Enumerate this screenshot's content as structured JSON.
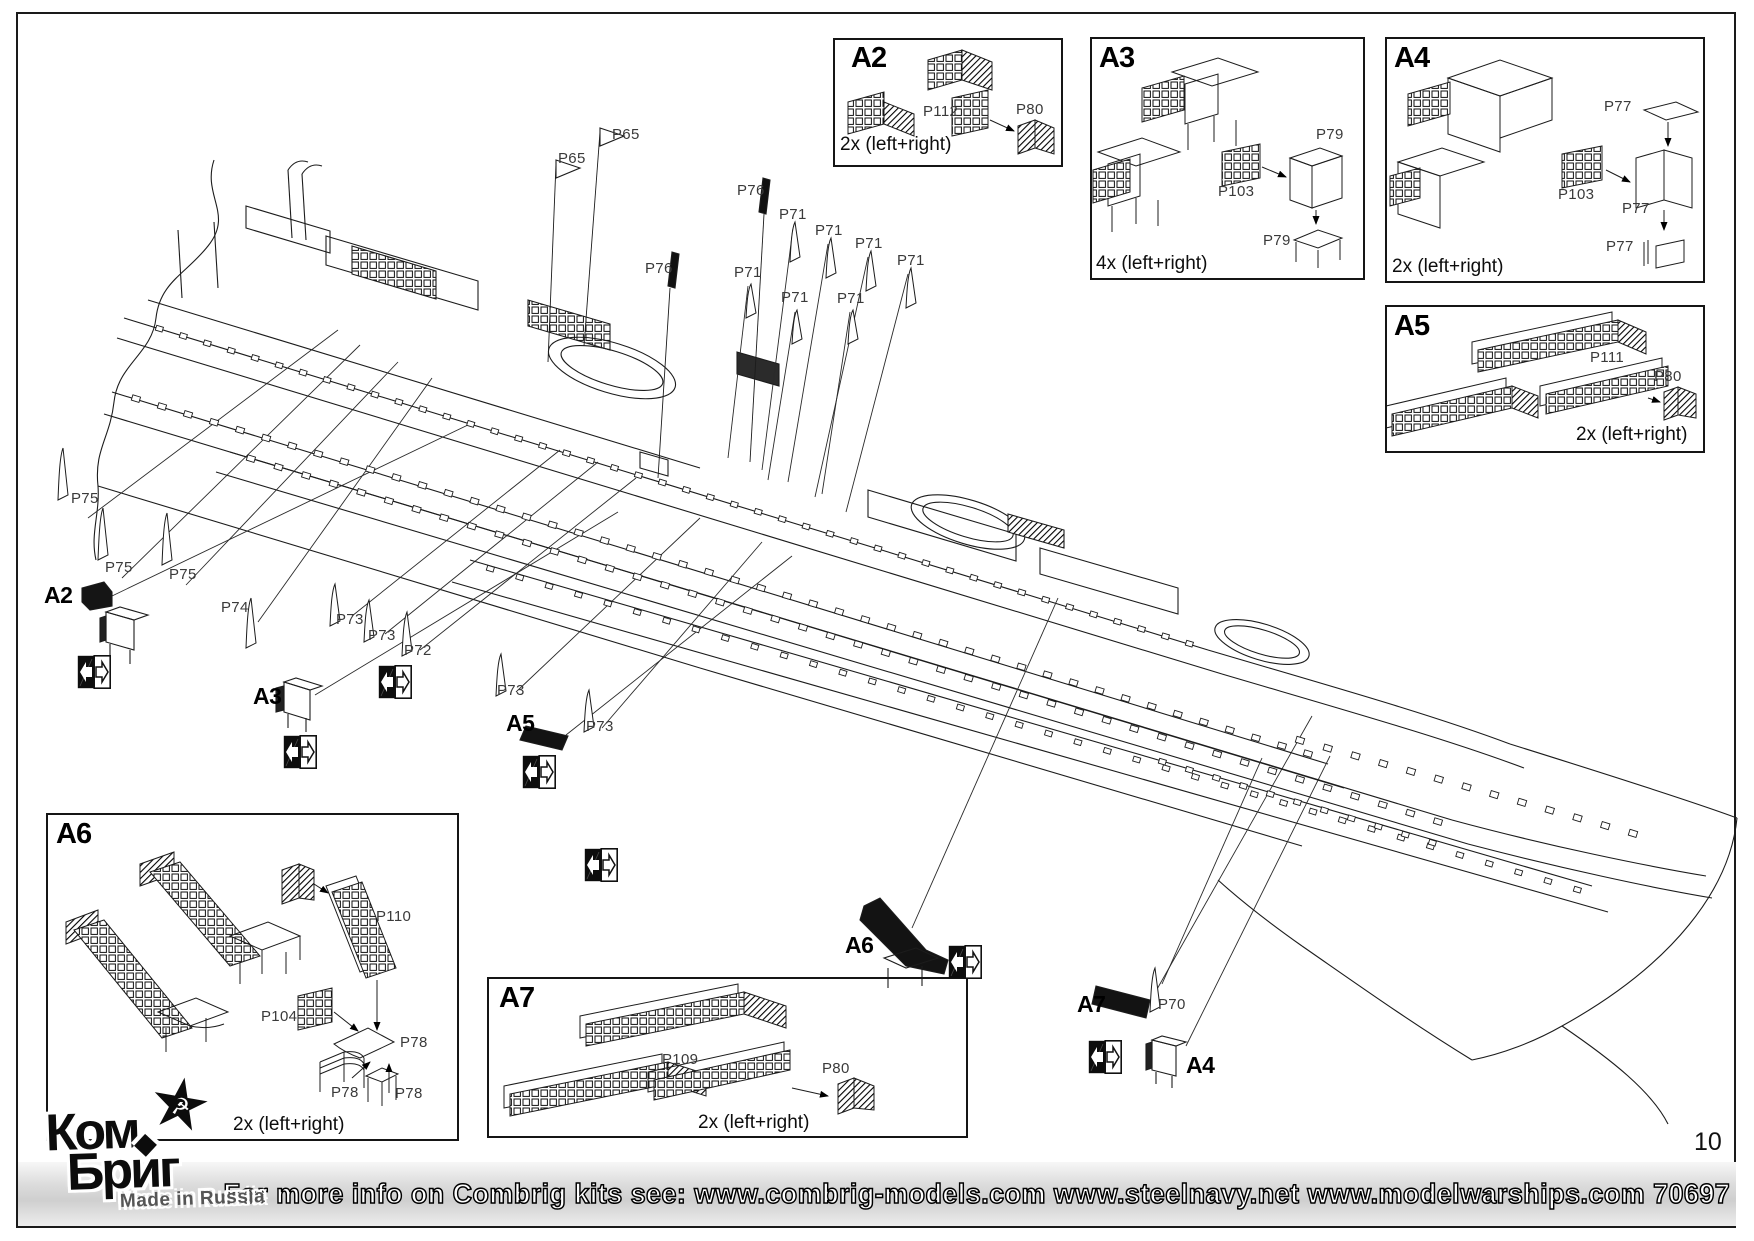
{
  "page": {
    "number": "10",
    "kit_number": "70697"
  },
  "banner": {
    "text": "For more info on Combrig kits see: www.combrig-models.com www.steelnavy.net  www.modelwarships.com  70697"
  },
  "logo": {
    "line1": "Ком",
    "line2": "Бриг",
    "star_icon": "★",
    "hammer_sickle_icon": "☭",
    "diamond_icon": "◆",
    "subtitle": "Made in Russia"
  },
  "detail_boxes": [
    {
      "id": "A2",
      "label": "A2",
      "quantity": "2x (left+right)",
      "parts": [
        {
          "label": "P112",
          "x": 923,
          "y": 103
        },
        {
          "label": "P80",
          "x": 1016,
          "y": 101
        }
      ]
    },
    {
      "id": "A3",
      "label": "A3",
      "quantity": "4x (left+right)",
      "parts": [
        {
          "label": "P79",
          "x": 1316,
          "y": 126
        },
        {
          "label": "P103",
          "x": 1218,
          "y": 183
        },
        {
          "label": "P79",
          "x": 1263,
          "y": 232
        }
      ]
    },
    {
      "id": "A4",
      "label": "A4",
      "quantity": "2x (left+right)",
      "parts": [
        {
          "label": "P77",
          "x": 1604,
          "y": 98
        },
        {
          "label": "P103",
          "x": 1558,
          "y": 186
        },
        {
          "label": "P77",
          "x": 1622,
          "y": 200
        },
        {
          "label": "P77",
          "x": 1606,
          "y": 238
        }
      ]
    },
    {
      "id": "A5",
      "label": "A5",
      "quantity": "2x (left+right)",
      "parts": [
        {
          "label": "P111",
          "x": 1590,
          "y": 349
        },
        {
          "label": "P80",
          "x": 1654,
          "y": 368
        }
      ]
    },
    {
      "id": "A6",
      "label": "A6",
      "quantity": "2x (left+right)",
      "parts": [
        {
          "label": "P110",
          "x": 376,
          "y": 908
        },
        {
          "label": "P104",
          "x": 261,
          "y": 1008
        },
        {
          "label": "P78",
          "x": 400,
          "y": 1034
        },
        {
          "label": "P78",
          "x": 331,
          "y": 1084
        },
        {
          "label": "P78",
          "x": 395,
          "y": 1085
        }
      ]
    },
    {
      "id": "A7",
      "label": "A7",
      "quantity": "2x (left+right)",
      "parts": [
        {
          "label": "P109",
          "x": 662,
          "y": 1051
        },
        {
          "label": "P80",
          "x": 822,
          "y": 1060
        }
      ]
    }
  ],
  "callouts": [
    {
      "kind": "part",
      "text": "P65",
      "x": 612,
      "y": 126
    },
    {
      "kind": "part",
      "text": "P65",
      "x": 558,
      "y": 150
    },
    {
      "kind": "part",
      "text": "P76",
      "x": 737,
      "y": 182
    },
    {
      "kind": "part",
      "text": "P76",
      "x": 645,
      "y": 260
    },
    {
      "kind": "part",
      "text": "P71",
      "x": 779,
      "y": 206
    },
    {
      "kind": "part",
      "text": "P71",
      "x": 815,
      "y": 222
    },
    {
      "kind": "part",
      "text": "P71",
      "x": 855,
      "y": 235
    },
    {
      "kind": "part",
      "text": "P71",
      "x": 897,
      "y": 252
    },
    {
      "kind": "part",
      "text": "P71",
      "x": 734,
      "y": 264
    },
    {
      "kind": "part",
      "text": "P71",
      "x": 781,
      "y": 289
    },
    {
      "kind": "part",
      "text": "P71",
      "x": 837,
      "y": 290
    },
    {
      "kind": "part",
      "text": "P75",
      "x": 71,
      "y": 490
    },
    {
      "kind": "part",
      "text": "P75",
      "x": 105,
      "y": 559
    },
    {
      "kind": "part",
      "text": "P75",
      "x": 169,
      "y": 566
    },
    {
      "kind": "part",
      "text": "P74",
      "x": 221,
      "y": 599
    },
    {
      "kind": "part",
      "text": "P73",
      "x": 336,
      "y": 611
    },
    {
      "kind": "part",
      "text": "P73",
      "x": 368,
      "y": 627
    },
    {
      "kind": "part",
      "text": "P72",
      "x": 404,
      "y": 642
    },
    {
      "kind": "part",
      "text": "P73",
      "x": 497,
      "y": 682
    },
    {
      "kind": "part",
      "text": "P73",
      "x": 586,
      "y": 718
    },
    {
      "kind": "part",
      "text": "P70",
      "x": 1158,
      "y": 996
    },
    {
      "kind": "assembly",
      "text": "A2",
      "x": 44,
      "y": 582
    },
    {
      "kind": "assembly",
      "text": "A3",
      "x": 253,
      "y": 683
    },
    {
      "kind": "assembly",
      "text": "A5",
      "x": 506,
      "y": 710
    },
    {
      "kind": "assembly",
      "text": "A6",
      "x": 845,
      "y": 932
    },
    {
      "kind": "assembly",
      "text": "A7",
      "x": 1077,
      "y": 991
    },
    {
      "kind": "assembly",
      "text": "A4",
      "x": 1186,
      "y": 1052
    }
  ],
  "arrow_icons": [
    {
      "x": 77,
      "y": 655
    },
    {
      "x": 283,
      "y": 735
    },
    {
      "x": 378,
      "y": 665
    },
    {
      "x": 522,
      "y": 755
    },
    {
      "x": 584,
      "y": 848
    },
    {
      "x": 948,
      "y": 945
    },
    {
      "x": 1088,
      "y": 1040
    }
  ]
}
